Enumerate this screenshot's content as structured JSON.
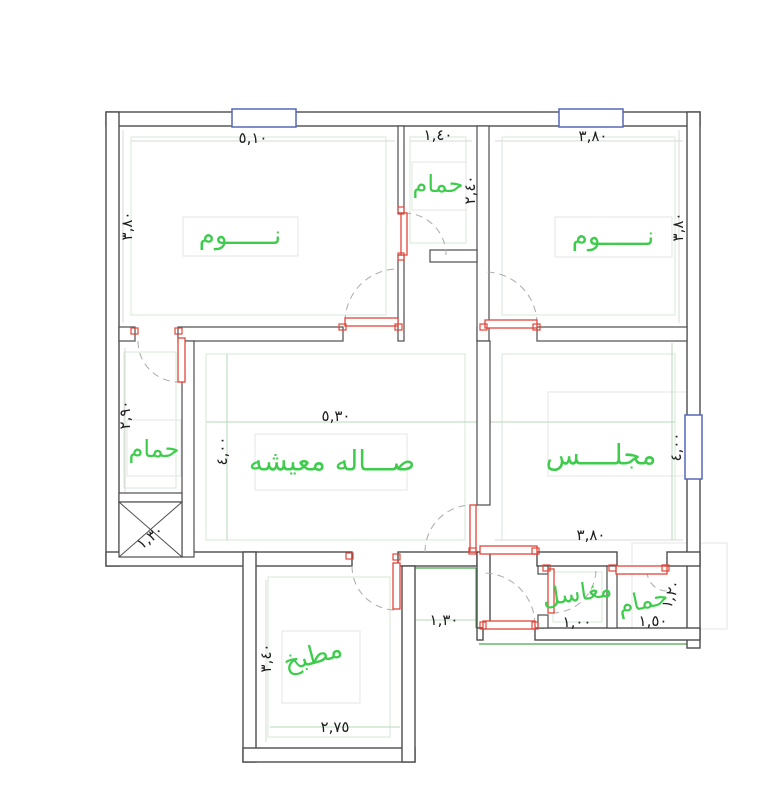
{
  "plan": {
    "title": "floor-plan",
    "colors": {
      "label_green": "#3ecc4c",
      "wall_dark": "#4d4d4d",
      "exterior_green": "#49a84f",
      "door_red": "#e1453a",
      "window_blue": "#5568b8",
      "dim_text": "#1c1c1c",
      "arc_gray": "#ababab",
      "inset_green": "#d4ead4",
      "faint_gray": "#e2e2e2"
    },
    "rooms": [
      {
        "id": "bedroom-left",
        "label": "نــــــوم"
      },
      {
        "id": "bath-top",
        "label": "حمام"
      },
      {
        "id": "bedroom-right",
        "label": "نــــــوم"
      },
      {
        "id": "living-hall",
        "label": "صـــاله معيشه"
      },
      {
        "id": "majlis",
        "label": "مجلــــس"
      },
      {
        "id": "bath-left",
        "label": "حمام"
      },
      {
        "id": "kitchen",
        "label": "مطبخ"
      },
      {
        "id": "sinks",
        "label": "مغاسل"
      },
      {
        "id": "bath-bottom",
        "label": "حمام"
      }
    ],
    "dimensions": [
      {
        "id": "bedroom-left-width",
        "text": "٥,١٠"
      },
      {
        "id": "bath-top-width",
        "text": "١,٤٠"
      },
      {
        "id": "bedroom-right-width",
        "text": "٣,٨٠"
      },
      {
        "id": "bedroom-left-depth",
        "text": "٣,٨٠"
      },
      {
        "id": "bath-top-depth",
        "text": "٢,٤٠"
      },
      {
        "id": "bedroom-right-depth",
        "text": "٣,٨٠"
      },
      {
        "id": "bath-left-depth",
        "text": "٢,٩٠"
      },
      {
        "id": "living-depth",
        "text": "٤,٠٠"
      },
      {
        "id": "living-width",
        "text": "٥,٣٠"
      },
      {
        "id": "majlis-depth",
        "text": "٤,٠٠"
      },
      {
        "id": "majlis-width",
        "text": "٣,٨٠"
      },
      {
        "id": "shaft-size",
        "text": "١,٣٠"
      },
      {
        "id": "kitchen-depth",
        "text": "٣,٤٠"
      },
      {
        "id": "kitchen-width",
        "text": "٢,٧٥"
      },
      {
        "id": "corridor-width",
        "text": "١,٣٠"
      },
      {
        "id": "sinks-width",
        "text": "١,٠٠"
      },
      {
        "id": "bath-bottom-width",
        "text": "١,٥٠"
      },
      {
        "id": "bath-bottom-depth",
        "text": "١,٢٠"
      }
    ]
  }
}
